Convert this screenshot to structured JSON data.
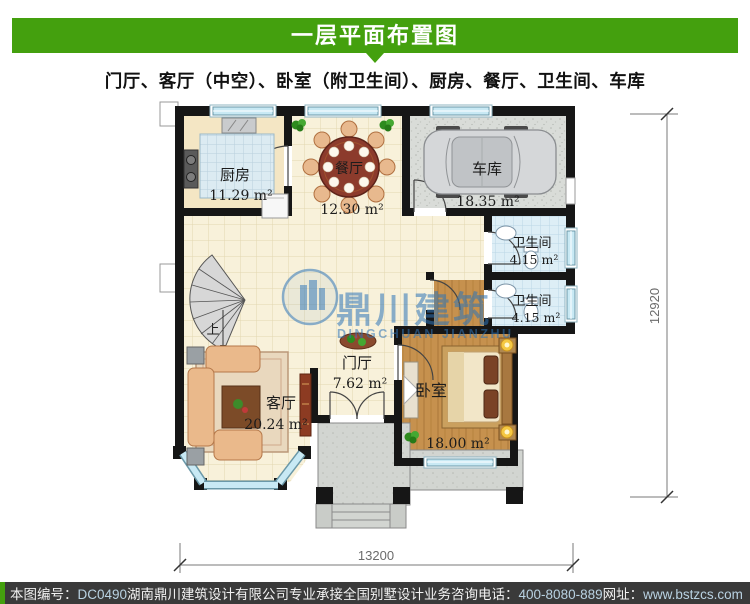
{
  "header": {
    "title": "一层平面布置图"
  },
  "subtitle": "门厅、客厅（中空）、卧室（附卫生间）、厨房、餐厅、卫生间、车库",
  "plan": {
    "rooms": {
      "kitchen": {
        "name": "厨房",
        "area": "11.29 m²"
      },
      "dining": {
        "name": "餐厅",
        "area": "12.30 m²"
      },
      "garage": {
        "name": "车库",
        "area": "18.35 m²"
      },
      "bath_upper": {
        "name": "卫生间",
        "area": "4.15 m²"
      },
      "bath_lower": {
        "name": "卫生间",
        "area": "4.15 m²"
      },
      "living": {
        "name": "客厅",
        "area": "20.24 m²"
      },
      "foyer": {
        "name": "门厅",
        "area": "7.62 m²"
      },
      "bedroom": {
        "name": "卧室",
        "area": "18.00 m²"
      }
    },
    "stair_up_label": "上",
    "dimensions": {
      "bottom": "13200",
      "right": "12920"
    }
  },
  "watermark": {
    "name_cn": "鼎川建筑",
    "name_en": "DINGCHUAN JIANZHU"
  },
  "footer": {
    "plan_number_label": "本图编号：",
    "plan_number": "DC0490",
    "company_line": "湖南鼎川建筑设计有限公司专业承接全国别墅设计业务",
    "phone_label": "咨询电话：",
    "phone": "400-8080-889",
    "website_label": "网址：",
    "website": "www.bstzcs.com"
  },
  "colors": {
    "header_green": "#44a00e",
    "footer_bg": "#3a3a3a",
    "watermark_blue": "#2d74b8"
  }
}
